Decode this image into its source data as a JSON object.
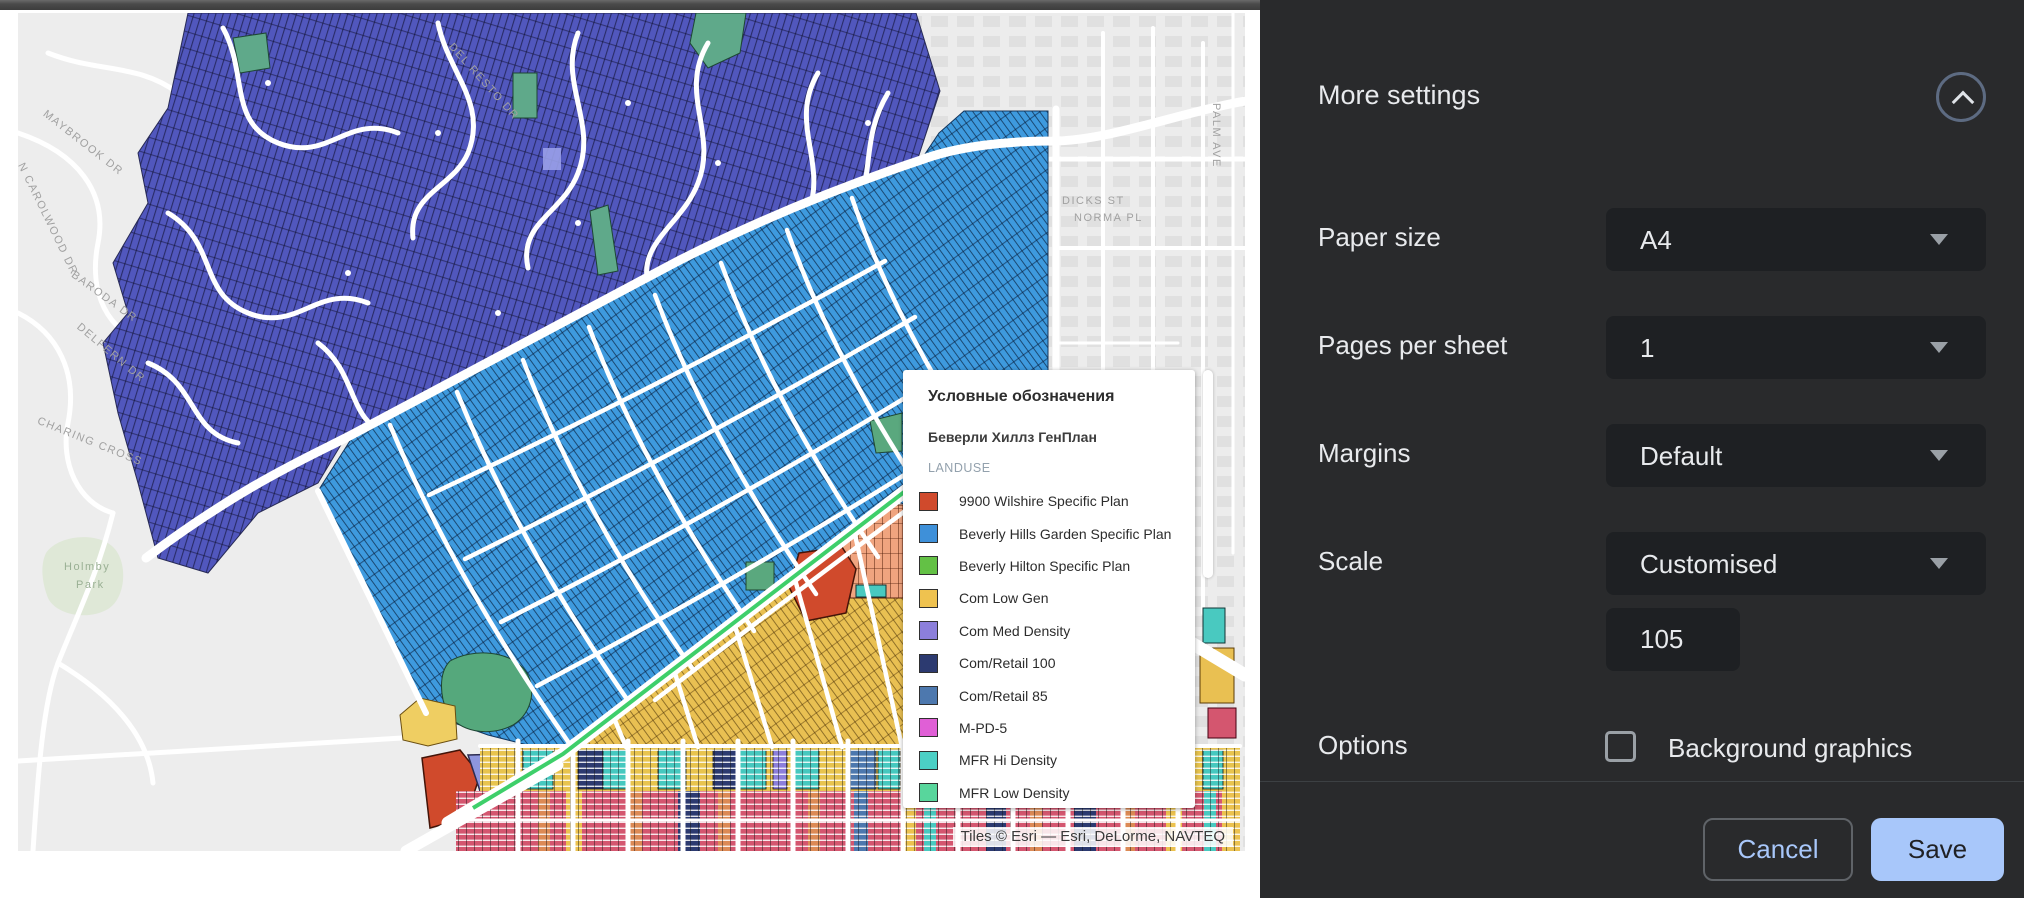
{
  "print_dialog": {
    "more_settings_label": "More settings",
    "rows": [
      {
        "label": "Paper size",
        "value": "A4"
      },
      {
        "label": "Pages per sheet",
        "value": "1"
      },
      {
        "label": "Margins",
        "value": "Default"
      },
      {
        "label": "Scale",
        "value": "Customised",
        "input_value": "105"
      },
      {
        "label": "Options",
        "checkbox_label": "Background graphics",
        "checked": false
      }
    ],
    "footer": {
      "cancel_label": "Cancel",
      "save_label": "Save"
    },
    "colors": {
      "panel_bg": "#292a2c",
      "control_bg": "#1e2023",
      "accent": "#a8c7fa",
      "text": "#e8eaed"
    }
  },
  "map_preview": {
    "attribution": "Tiles © Esri — Esri, DeLorme, NAVTEQ",
    "legend": {
      "title": "Условные обозначения",
      "subtitle": "Беверли Хиллз ГенПлан",
      "group_label": "LANDUSE",
      "items": [
        {
          "label": "9900 Wilshire Specific Plan",
          "color": "#d04a2c"
        },
        {
          "label": "Beverly Hills Garden Specific Plan",
          "color": "#3e90d9"
        },
        {
          "label": "Beverly Hilton Specific Plan",
          "color": "#63c145"
        },
        {
          "label": "Com Low Gen",
          "color": "#efc24f"
        },
        {
          "label": "Com Med Density",
          "color": "#8c7fdb"
        },
        {
          "label": "Com/Retail 100",
          "color": "#2c3a70"
        },
        {
          "label": "Com/Retail 85",
          "color": "#4d78ae"
        },
        {
          "label": "M-PD-5",
          "color": "#e05fd6"
        },
        {
          "label": "MFR Hi Density",
          "color": "#4bd0c5"
        },
        {
          "label": "MFR Low Density",
          "color": "#58d69c"
        }
      ]
    },
    "street_labels": [
      {
        "t": "MAYBROOK DR",
        "x": 30,
        "y": 95,
        "r": 38
      },
      {
        "t": "N CAROLWOOD DR",
        "x": 8,
        "y": 148,
        "r": 64
      },
      {
        "t": "BARODA DR",
        "x": 58,
        "y": 256,
        "r": 36
      },
      {
        "t": "DELFERN DR",
        "x": 64,
        "y": 308,
        "r": 40
      },
      {
        "t": "CHARING CROSS",
        "x": 22,
        "y": 402,
        "r": 22
      },
      {
        "t": "DEL RESTO DR",
        "x": 437,
        "y": 28,
        "r": 48
      },
      {
        "t": "Holmby",
        "x": 46,
        "y": 548,
        "r": 0,
        "c": "#9ab094"
      },
      {
        "t": "Park",
        "x": 58,
        "y": 566,
        "r": 0,
        "c": "#9ab094"
      },
      {
        "t": "PALM AVE",
        "x": 1204,
        "y": 90,
        "r": 90
      },
      {
        "t": "DICKS ST",
        "x": 1044,
        "y": 182,
        "r": 0
      },
      {
        "t": "NORMA PL",
        "x": 1056,
        "y": 199,
        "r": 0
      }
    ]
  }
}
